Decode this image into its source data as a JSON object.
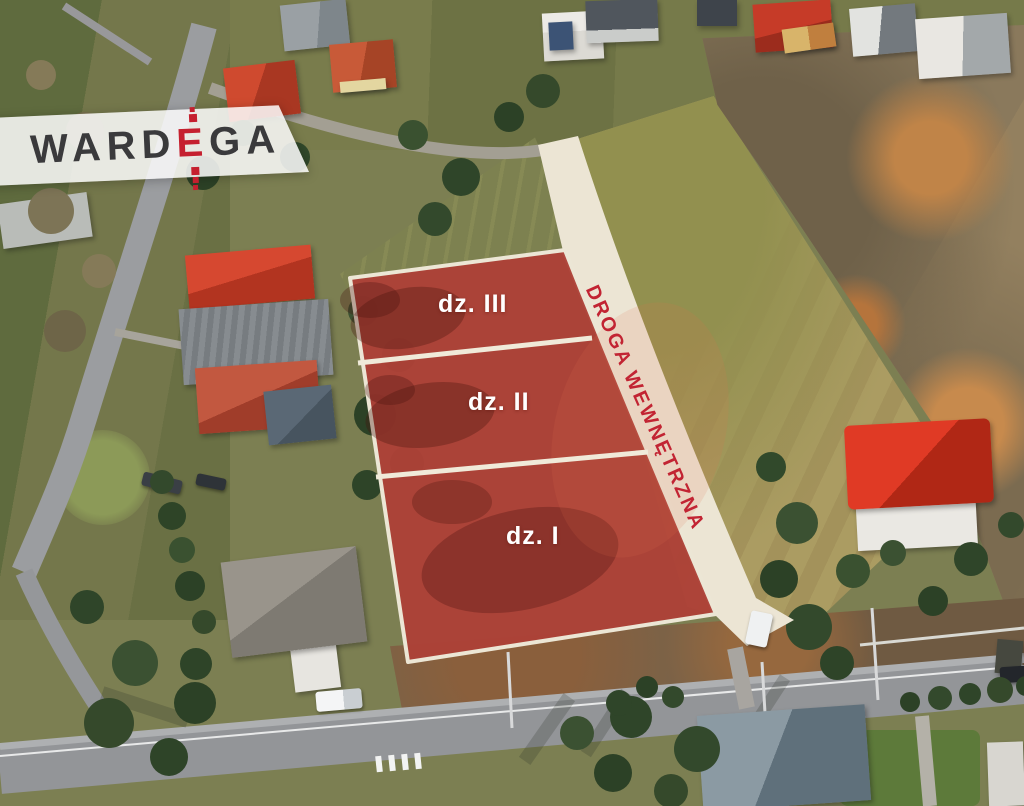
{
  "logo": {
    "name": "WARDEGA",
    "part1": "WARD",
    "accent": "E",
    "part2": "GA",
    "text_color": "#3a3a3c",
    "accent_color": "#c5202f",
    "banner_background": "rgba(252,252,251,0.86)"
  },
  "plots": {
    "overlay_color": "#ad4137",
    "divider_color": "#f0ead9",
    "label_color": "#ffffff",
    "items": [
      {
        "id": "dz-III",
        "label": "dz. III"
      },
      {
        "id": "dz-II",
        "label": "dz. II"
      },
      {
        "id": "dz-I",
        "label": "dz. I"
      }
    ]
  },
  "internal_road": {
    "label": "DROGA WEWNĘTRZNA",
    "label_color": "#c22433",
    "surface_color": "#ece5d4"
  }
}
